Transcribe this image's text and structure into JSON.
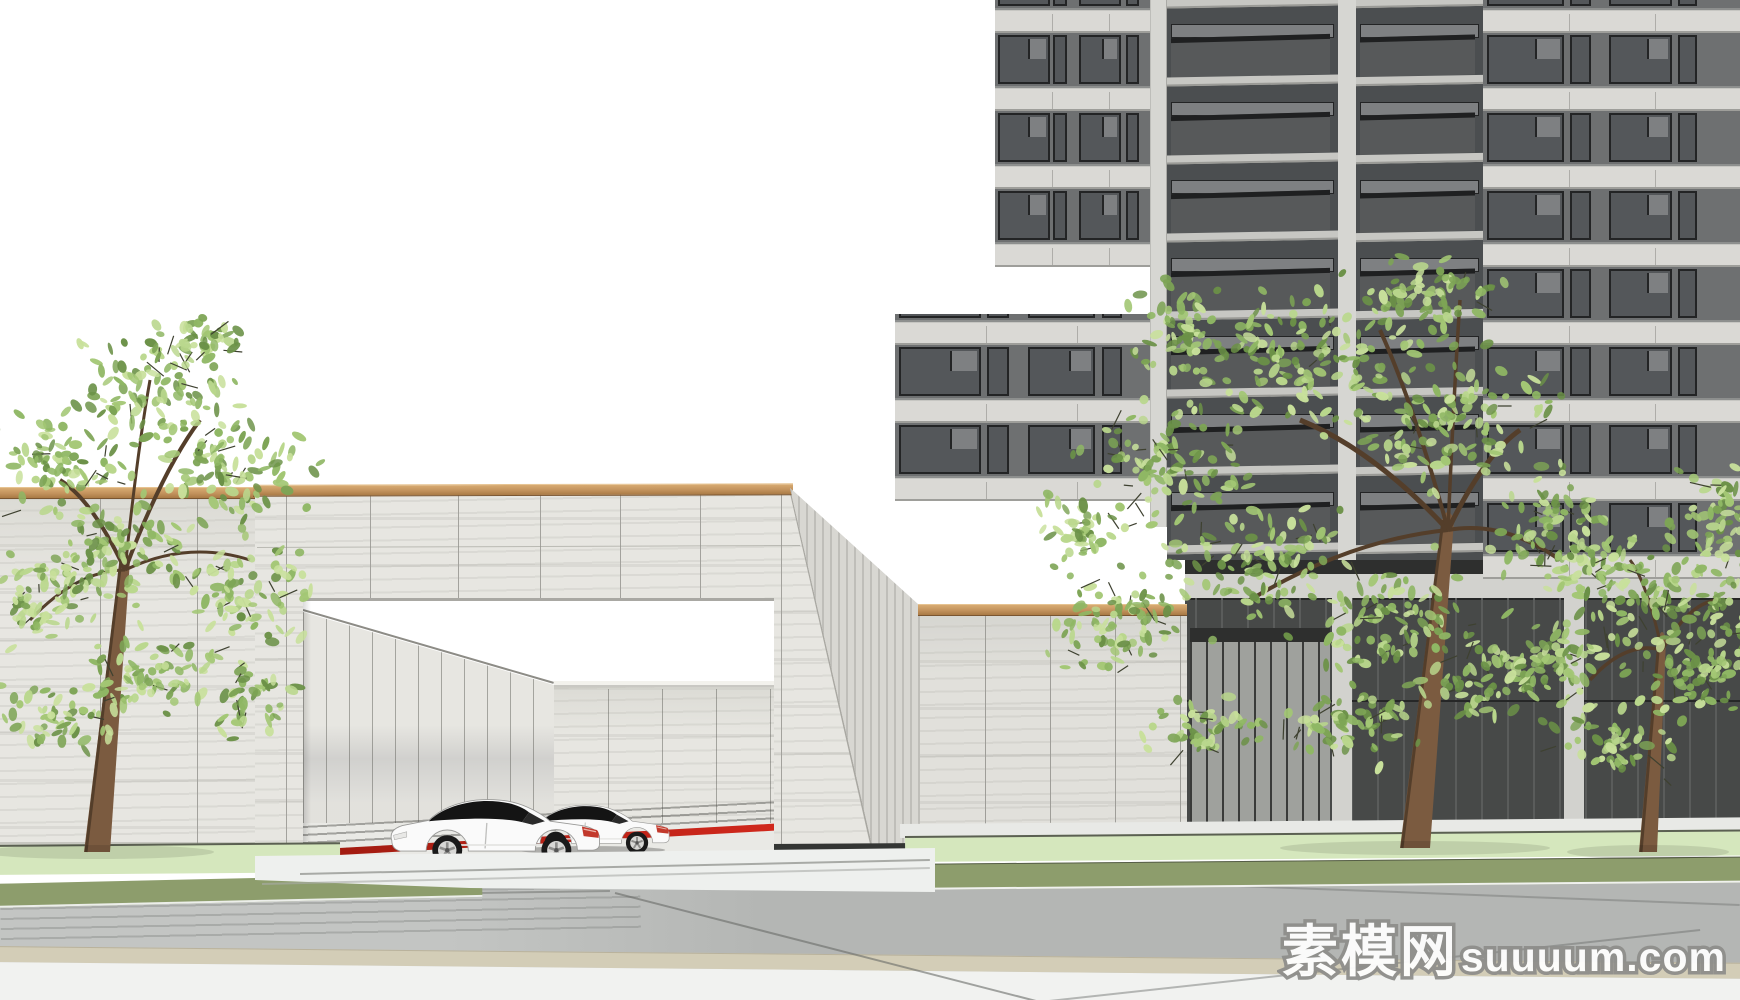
{
  "watermark": {
    "cn": "素模网",
    "latin": "suuuum.com"
  },
  "scene": {
    "type": "3d-architectural-rendering",
    "subject": "residential compound entrance gate with two parked coupes, high-rise tower and street trees",
    "entrance_gate": {
      "material": "travertine stone",
      "coping": "wood",
      "opening": "rectangular portal",
      "floor_accent_stripe": "#c8231a"
    },
    "vehicles": {
      "count": 2,
      "type": "coupe",
      "body_color": "#fafafa",
      "facing": "left"
    },
    "trees": {
      "count": 3
    },
    "tower": {
      "style": "residential high-rise",
      "features": [
        "window bands",
        "balconies",
        "stone slab bands"
      ]
    }
  },
  "colors": {
    "sky": "#ffffff",
    "joint": "#a3a29d",
    "wood_dark": "#7a5530",
    "slab": "#dad9d5",
    "slab_line": "#9e9e9a",
    "win_glass": "#54575a",
    "win_frame": "#232425",
    "win_light": "#7e8082",
    "infill": "#6e7071",
    "balc_glass": "#57595a",
    "balc_cap": "#1f2021",
    "balc_slab": "#c7c7c3",
    "balc_back": "#4b4e50",
    "pier": "#d6d6d2",
    "base_dark": "#474948",
    "base_fascia": "#2e2f2e",
    "base_pier": "#d2d2ce",
    "lawn": "#d5e7bd",
    "lawn_curb": "rgba(60,62,55,0.8)",
    "olive": "#8d9d6c",
    "road": "#b4b6b4",
    "walk": "#e8e9e6",
    "apron": "#eef0ee",
    "tan": "#d3cdb7",
    "white_band": "#f1f2f0",
    "red1": "#9f1b10",
    "red2": "#d0281c",
    "plinth": "#343634",
    "leaf_palette": [
      "#b9d78c",
      "#a3c774",
      "#8fb764",
      "#7da455",
      "#6b9147",
      "#c8e09b"
    ],
    "twig": "#3e4130",
    "trunk": "#7b5b40",
    "trunk_dark": "#543e2a",
    "car_body": "#fafafa",
    "car_glass": "#141414",
    "tire": "#1a1a1a",
    "rim": "#d8d8d6",
    "tail": "#c2392c"
  }
}
